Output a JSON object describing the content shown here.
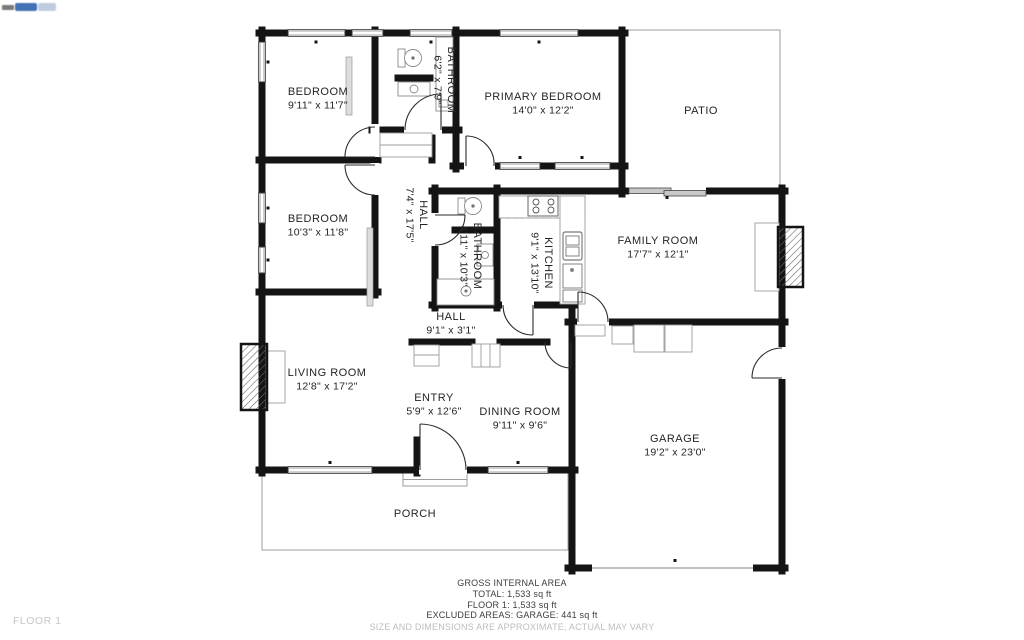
{
  "floor_label": "FLOOR 1",
  "summary": {
    "line1": "GROSS INTERNAL AREA",
    "line2": "TOTAL: 1,533 sq ft",
    "line3": "FLOOR 1: 1,533 sq ft",
    "line4": "EXCLUDED AREAS: GARAGE: 441 sq ft",
    "disclaimer": "SIZE AND DIMENSIONS ARE APPROXIMATE, ACTUAL MAY VARY"
  },
  "rooms": [
    {
      "name": "BEDROOM",
      "dims": "9'11\" x 11'7\"",
      "x": 318,
      "y": 95,
      "rotate": 0
    },
    {
      "name": "BATHROOM",
      "dims": "6'2\" x 7'9\"",
      "x": 448,
      "y": 80,
      "rotate": 90
    },
    {
      "name": "PRIMARY BEDROOM",
      "dims": "14'0\" x 12'2\"",
      "x": 543,
      "y": 100,
      "rotate": 0
    },
    {
      "name": "PATIO",
      "dims": "",
      "x": 701,
      "y": 114,
      "rotate": 0
    },
    {
      "name": "BEDROOM",
      "dims": "10'3\" x 11'8\"",
      "x": 318,
      "y": 222,
      "rotate": 0
    },
    {
      "name": "HALL",
      "dims": "7'4\" x 17'5\"",
      "x": 420,
      "y": 215,
      "rotate": 90
    },
    {
      "name": "BATHROOM",
      "dims": "4'11\" x 10'3\"",
      "x": 474,
      "y": 256,
      "rotate": 90
    },
    {
      "name": "KITCHEN",
      "dims": "9'1\" x 13'10\"",
      "x": 545,
      "y": 263,
      "rotate": 90
    },
    {
      "name": "FAMILY ROOM",
      "dims": "17'7\" x 12'1\"",
      "x": 658,
      "y": 244,
      "rotate": 0
    },
    {
      "name": "HALL",
      "dims": "9'1\" x 3'1\"",
      "x": 451,
      "y": 320,
      "rotate": 0
    },
    {
      "name": "LIVING ROOM",
      "dims": "12'8\" x 17'2\"",
      "x": 327,
      "y": 376,
      "rotate": 0
    },
    {
      "name": "ENTRY",
      "dims": "5'9\" x 12'6\"",
      "x": 434,
      "y": 401,
      "rotate": 0
    },
    {
      "name": "DINING ROOM",
      "dims": "9'11\" x 9'6\"",
      "x": 520,
      "y": 415,
      "rotate": 0
    },
    {
      "name": "GARAGE",
      "dims": "19'2\" x 23'0\"",
      "x": 675,
      "y": 442,
      "rotate": 0
    },
    {
      "name": "PORCH",
      "dims": "",
      "x": 415,
      "y": 517,
      "rotate": 0
    }
  ],
  "colors": {
    "wall": "#141414",
    "window_fill": "#c9c9c9",
    "thin_outline": "#9c9c9c",
    "label_text": "#242424",
    "muted_text": "#bdbdbd",
    "logo_blue": "#2e62ae",
    "logo_light_blue": "#b9c7dd"
  }
}
